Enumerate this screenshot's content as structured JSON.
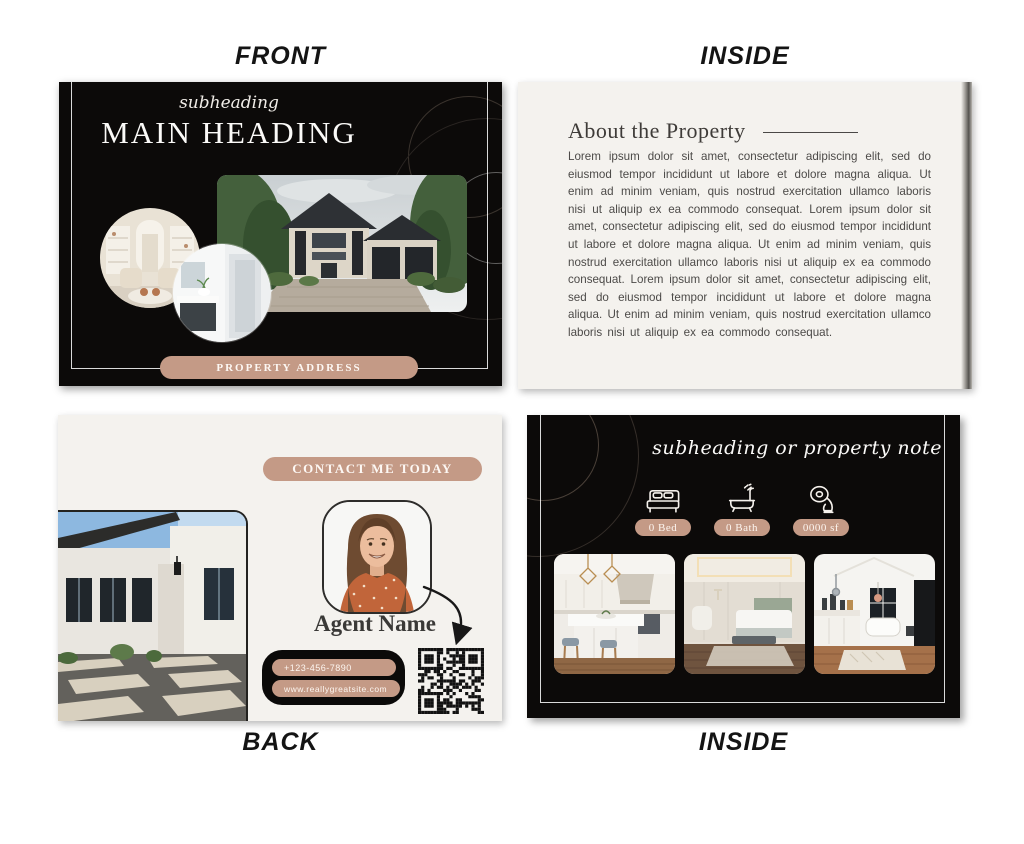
{
  "labels": {
    "front": "FRONT",
    "inside_top": "INSIDE",
    "back": "BACK",
    "inside_bottom": "INSIDE"
  },
  "colors": {
    "accent_tan": "#c49a86",
    "card_black": "#0c0a09",
    "card_cream": "#f4f2ee",
    "page_background": "#ffffff"
  },
  "front_card": {
    "subheading": "subheading",
    "main_heading": "MAIN HEADING",
    "address_label": "PROPERTY ADDRESS"
  },
  "inside_top_card": {
    "heading": "About the Property",
    "body": "Lorem ipsum dolor sit amet, consectetur adipiscing elit, sed do eiusmod tempor incididunt ut labore et dolore magna aliqua. Ut enim ad minim veniam, quis nostrud exercitation ullamco laboris nisi ut aliquip ex ea commodo consequat. Lorem ipsum dolor sit amet, consectetur adipiscing elit, sed do eiusmod tempor incididunt ut labore et dolore magna aliqua. Ut enim ad minim veniam, quis nostrud exercitation ullamco laboris nisi ut aliquip ex ea commodo consequat. Lorem ipsum dolor sit amet, consectetur adipiscing elit, sed do eiusmod tempor incididunt ut labore et dolore magna aliqua. Ut enim ad minim veniam, quis nostrud exercitation ullamco laboris nisi ut aliquip ex ea commodo consequat."
  },
  "back_card": {
    "contact_label": "CONTACT ME TODAY",
    "agent_name": "Agent Name",
    "phone": "+123-456-7890",
    "website": "www.reallygreatsite.com"
  },
  "inside_bottom_card": {
    "subheading": "subheading or property note",
    "stats": [
      {
        "icon": "bed-icon",
        "label": "0 Bed"
      },
      {
        "icon": "bath-icon",
        "label": "0 Bath"
      },
      {
        "icon": "tape-measure-icon",
        "label": "0000 sf"
      }
    ]
  }
}
